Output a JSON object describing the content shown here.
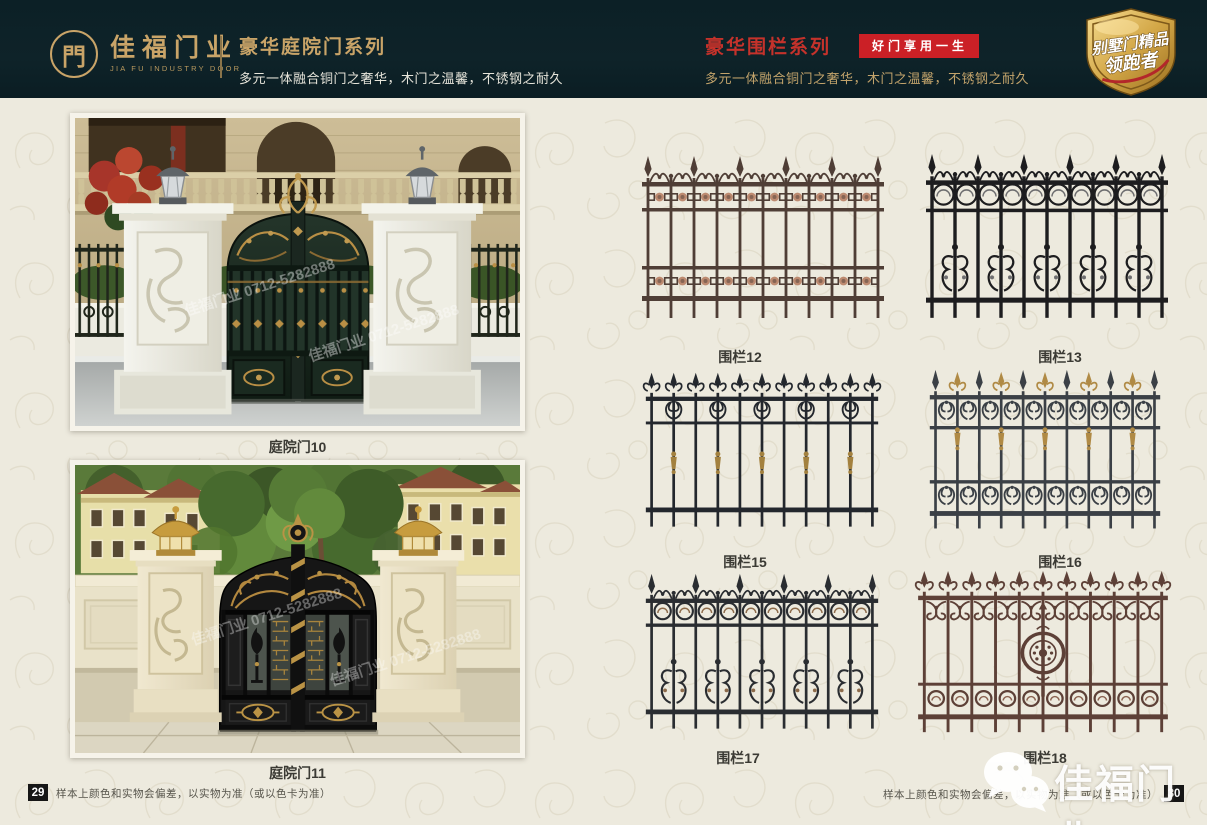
{
  "header": {
    "logo": {
      "glyph": "門",
      "name": "佳福门业",
      "name_en": "JIA FU INDUSTRY DOOR"
    },
    "left_series": {
      "title": "豪华庭院门系列",
      "subtitle": "多元一体融合铜门之奢华，木门之温馨，不锈钢之耐久"
    },
    "right_series": {
      "title": "豪华围栏系列",
      "badge": "好门享用一生",
      "subtitle": "多元一体融合铜门之奢华，木门之温馨，不锈钢之耐久"
    },
    "corner_badge": {
      "line1": "别墅门精品",
      "line2": "领跑者"
    },
    "colors": {
      "header_bg": "#0d2127",
      "gold": "#c9a468",
      "red": "#c5322b",
      "badge_red": "#cb2026"
    }
  },
  "left_page": {
    "products": [
      {
        "label": "庭院门10"
      },
      {
        "label": "庭院门11"
      }
    ],
    "watermark": "佳福门业 0712-5282888",
    "footer": {
      "page_number": "29",
      "note": "样本上颜色和实物会偏差，以实物为准（或以色卡为准）"
    }
  },
  "right_page": {
    "products": [
      {
        "label": "围栏12",
        "color": "#4f3e36",
        "accent": "#bd8a70",
        "style": "rosette-bands"
      },
      {
        "label": "围栏13",
        "color": "#1d1d1f",
        "accent": "#6e6e70",
        "style": "ring-cluster"
      },
      {
        "label": "围栏15",
        "color": "#23272d",
        "accent": "#a3813f",
        "style": "fleur-collars"
      },
      {
        "label": "围栏16",
        "color": "#3b4046",
        "accent": "#b08a45",
        "style": "lyre-bands"
      },
      {
        "label": "围栏17",
        "color": "#2a2d31",
        "accent": "#8d6b4b",
        "style": "ring-hearts"
      },
      {
        "label": "围栏18",
        "color": "#5d4037",
        "accent": "#8c6352",
        "style": "corner-medallion"
      }
    ],
    "watermark_logo": "佳福门业",
    "footer": {
      "page_number": "30",
      "note": "样本上颜色和实物会偏差，以实物为准（或以色卡为准）"
    }
  },
  "page_bg": "#edeade"
}
